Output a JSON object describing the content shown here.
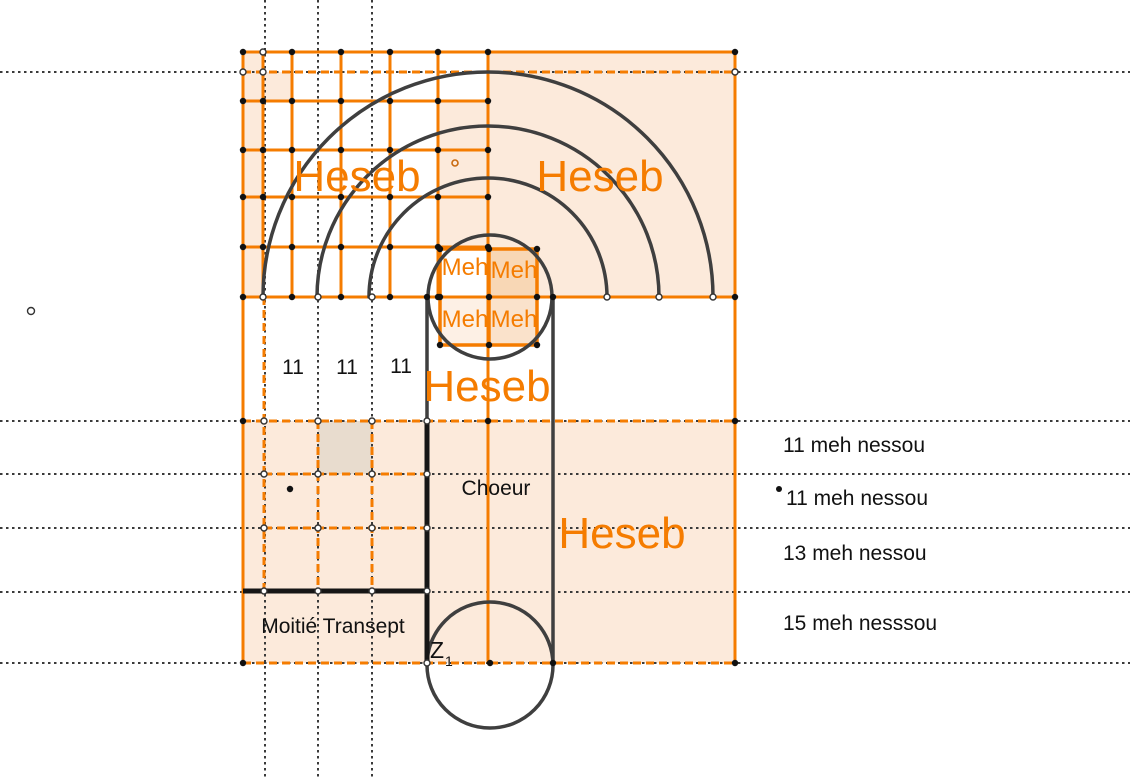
{
  "diagram": {
    "title_labels": {
      "heseb_top_left": "Heseb",
      "heseb_top_right": "Heseb",
      "heseb_middle": "Heseb",
      "heseb_lower_right": "Heseb"
    },
    "meh_cells": {
      "tl": "Meh",
      "tr": "Meh",
      "bl": "Meh",
      "br": "Meh"
    },
    "columns": {
      "c1": "11",
      "c2": "11",
      "c3": "11"
    },
    "areas": {
      "choeur": "Choeur",
      "moitie_transept": "Moitié Transept"
    },
    "point_label": {
      "base": "Z",
      "sub": "1"
    },
    "rows": {
      "r1": "11 meh nessou",
      "r2": "11 meh nessou",
      "r3": "13 meh nessou",
      "r4": "15 meh nesssou"
    },
    "colors": {
      "orange_line": "#F57C00",
      "fill_light": "#FCEADB",
      "fill_medium": "#F8D7B5",
      "fill_soft": "#FDF0E5",
      "fill_mid": "#FAE2CB",
      "fill_tan": "#E8DCCE",
      "arc_gray": "#3F3F3F",
      "thick_black": "#161616",
      "dotted_gray": "#3A3A3A"
    }
  }
}
